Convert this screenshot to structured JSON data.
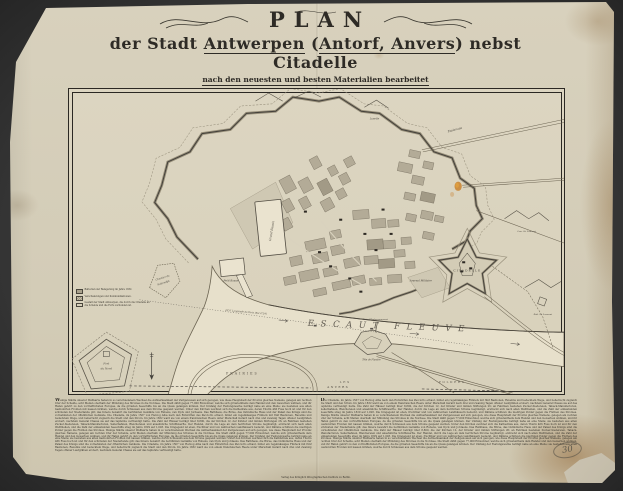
{
  "title": {
    "main": "PLAN",
    "line2_pre": "der Stadt ",
    "line2_u1": "Antwerpen",
    "line2_mid": " (",
    "line2_u2": "Antorf, Anvers",
    "line2_post": ") nebst Citadelle",
    "line3": "nach den neuesten und besten Materialien bearbeitet",
    "line4": "Metallographirt im Königlich lithographischen Institut zu Berlin, und mit statistischen Notizen versehen vom Freiherrn von Zedlitz."
  },
  "map": {
    "labels": {
      "river": "ESCAUT FLEUVE",
      "grand_bassin": "Grand Bassin",
      "petit_bassin": "Petit Bassin",
      "citadelle": "CITADELLE",
      "arsenal": "Arsenal Militaire",
      "esplanade": "Esplanade",
      "lunette": "Lunette",
      "chantier_1": "Chantier du",
      "chantier_2": "Kattendijk",
      "fort_nord_1": "Fort",
      "fort_nord_2": "du Nord",
      "tete_flandre": "Tête de Flandre",
      "tete_embarq": "Tête d'Embarquement",
      "lun_st_laurent": "Lun. St. Laurent",
      "red_st_laurent": "Réd. St. Laurent",
      "prairies": "PRAIRIES",
      "les": "LES",
      "polders": "POLDERS",
      "anvers": "ANVERS",
      "latitude": "Latitude Nord 51°13′ N.",
      "longitude": "22°6′ Longitude de Paris (Est 4°24′)"
    },
    "legend": {
      "item1": "Batterien der Belagerung im Jahre 1832.",
      "item2": "Verschanzungen und Kommunikationen.",
      "item3": "Gestalt der Stadt Antwerpen, die durch die Citadelle an die Schelde und die Forts verbunden ist."
    }
  },
  "footer": {
    "col1": "Wenige Städte unserer Weltkarte haben in so verschiedenem Wechsel die Aufmerksamkeit der Zeitgenossen auf sich gezogen, wie diese Hauptstadt der Provinz gleiches Namens, gelegen am rechten Ufer der Schelde, acht Meilen oberhalb der Mündung des Stromes in die Nordsee. Die Stadt zählt gegen 77,000 Einwohner, welche sich grösstentheils dem Handel und den Gewerben widmen, und ihr Hafen gehört zu den vortrefflichsten Europas, da die grössten Seeschiffe bis an die Quais gelangen können. Der Umfang der Festungswerke beträgt nahe an eine Meile; sie bestehen aus alten bastionirten Fronten mit nassen Gräben, welche durch Schleusen aus dem Strome gespeist werden. Unter den Kirchen zeichnet sich die Kathedrale aus, deren Thurm 466 Fuss hoch ist und für den schönsten der Niederlande gilt; das Innere bewahrt die berühmten Gemälde von Rubens, van Dyck und Jordaens. Das Rathhaus, die Börse, das Ostindische Haus und der Palast des Königs sind die vornehmsten der öffentlichen Gebäude. Die Citadelle, im Jahre 1567 von Herzog Alba nach den Entwürfen des Pacciotto erbaut, bildet ein regelmässiges Fünfeck mit fünf Bastionen, Ravelins und bedecktem Wege, und beherrscht zugleich die Stadt und den Strom. Im Jahre 1832 ward sie von einem französischen Heere unter Marschall Gérard nach drei und zwanzig Tagen offener Laufgräben erobert, nachdem General Chassé sie auf das tapferste vertheidigt hatte. Die Zahl der Häuser beträgt über 8,800, die der Kirchen 12, der Klöster und milden Stiftungen 26; an Fabriken bestehen Zucker-Siedereien, Taback-Manufacturen, Seilerbahnen, Bleichereien und ansehnliche Schiffswerfte. Der Handel, durch die Lage an dem herrlichen Strome begünstigt, erstreckt sich nach allen Welttheilen, und die Zahl der einlaufenden Seeschiffe stieg im Jahre 1829 auf 1,028. Die Umgegend ist eben, fruchtbar und von zahlreichen Landhäusern bedeckt, und Dämme schützen die niedrigen Polder gegen die Fluthen des Stromes. Wenige Städte unserer Weltkarte haben in so verschiedenem Wechsel die Aufmerksamkeit der Zeitgenossen auf sich gezogen, wie diese Hauptstadt der Provinz gleiches Namens, gelegen am rechten Ufer der Schelde, acht Meilen oberhalb der Mündung des Stromes in die Nordsee. Die Stadt zählt gegen 77,000 Einwohner, welche sich grösstentheils dem Handel und den Gewerben widmen, und ihr Hafen gehört zu den vortrefflichsten Europas, da die grössten Seeschiffe bis an die Quais gelangen können. Der Umfang der Festungswerke beträgt nahe an eine Meile; sie bestehen aus alten bastionirten Fronten mit nassen Gräben, welche durch Schleusen aus dem Strome gespeist werden. Unter den Kirchen zeichnet sich die Kathedrale aus, deren Thurm 466 Fuss hoch ist und für den schönsten der Niederlande gilt; das Innere bewahrt die berühmten Gemälde von Rubens, van Dyck und Jordaens. Das Rathhaus, die Börse, das Ostindische Haus und der Palast des Königs sind die vornehmsten der öffentlichen Gebäude. Die Citadelle, im Jahre 1567 von Herzog Alba nach den Entwürfen des Pacciotto erbaut, bildet ein regelmässiges Fünfeck mit fünf Bastionen, Ravelins und bedecktem Wege, und beherrscht zugleich die Stadt und den Strom. Im Jahre 1832 ward sie von einem französischen Heere unter Marschall Gérard nach drei und zwanzig Tagen offener Laufgräben erobert, nachdem General Chassé sie auf das tapferste vertheidigt hatte.",
    "col2": "Die Citadelle, im Jahre 1567 von Herzog Alba nach den Entwürfen des Pacciotto erbaut, bildet ein regelmässiges Fünfeck mit fünf Bastionen, Ravelins und bedecktem Wege, und beherrscht zugleich die Stadt und den Strom. Im Jahre 1832 ward sie von einem französischen Heere unter Marschall Gérard nach drei und zwanzig Tagen offener Laufgräben erobert, nachdem General Chassé sie auf das tapferste vertheidigt hatte. Die Zahl der Häuser beträgt über 8,800, die der Kirchen 12, der Klöster und milden Stiftungen 26; an Fabriken bestehen Zucker-Siedereien, Taback-Manufacturen, Seilerbahnen, Bleichereien und ansehnliche Schiffswerfte. Der Handel, durch die Lage an dem herrlichen Strome begünstigt, erstreckt sich nach allen Welttheilen, und die Zahl der einlaufenden Seeschiffe stieg im Jahre 1829 auf 1,028. Die Umgegend ist eben, fruchtbar und von zahlreichen Landhäusern bedeckt, und Dämme schützen die niedrigen Polder gegen die Fluthen des Stromes. Wenige Städte unserer Weltkarte haben in so verschiedenem Wechsel die Aufmerksamkeit der Zeitgenossen auf sich gezogen, wie diese Hauptstadt der Provinz gleiches Namens, gelegen am rechten Ufer der Schelde, acht Meilen oberhalb der Mündung des Stromes in die Nordsee. Die Stadt zählt gegen 77,000 Einwohner, welche sich grösstentheils dem Handel und den Gewerben widmen, und ihr Hafen gehört zu den vortrefflichsten Europas, da die grössten Seeschiffe bis an die Quais gelangen können. Der Umfang der Festungswerke beträgt nahe an eine Meile; sie bestehen aus alten bastionirten Fronten mit nassen Gräben, welche durch Schleusen aus dem Strome gespeist werden. Unter den Kirchen zeichnet sich die Kathedrale aus, deren Thurm 466 Fuss hoch ist und für den schönsten der Niederlande gilt; das Innere bewahrt die berühmten Gemälde von Rubens, van Dyck und Jordaens. Das Rathhaus, die Börse, das Ostindische Haus und der Palast des Königs sind die vornehmsten der öffentlichen Gebäude. Die Zahl der Häuser beträgt über 8,800, die der Kirchen 12, der Klöster und milden Stiftungen 26; an Fabriken bestehen Zucker-Siedereien, Taback-Manufacturen, Seilerbahnen, Bleichereien und ansehnliche Schiffswerfte. Der Handel, durch die Lage an dem herrlichen Strome begünstigt, erstreckt sich nach allen Welttheilen, und die Zahl der einlaufenden Seeschiffe stieg im Jahre 1829 auf 1,028. Die Umgegend ist eben, fruchtbar und von zahlreichen Landhäusern bedeckt, und Dämme schützen die niedrigen Polder gegen die Fluthen des Stromes. Wenige Städte unserer Weltkarte haben in so verschiedenem Wechsel die Aufmerksamkeit der Zeitgenossen auf sich gezogen, wie diese Hauptstadt der Provinz gleiches Namens, gelegen am rechten Ufer der Schelde, acht Meilen oberhalb der Mündung des Stromes in die Nordsee. Die Stadt zählt gegen 77,000 Einwohner, welche sich grösstentheils dem Handel und den Gewerben widmen, und ihr Hafen gehört zu den vortrefflichsten Europas, da die grössten Seeschiffe bis an die Quais gelangen können. Der Umfang der Festungswerke beträgt nahe an eine Meile; sie bestehen aus alten bastionirten Fronten mit nassen Gräben, welche durch Schleusen aus dem Strome gespeist werden.",
    "imprint": "Verlag des Königlich lithographischen Instituts zu Berlin.",
    "annotation": "30"
  }
}
